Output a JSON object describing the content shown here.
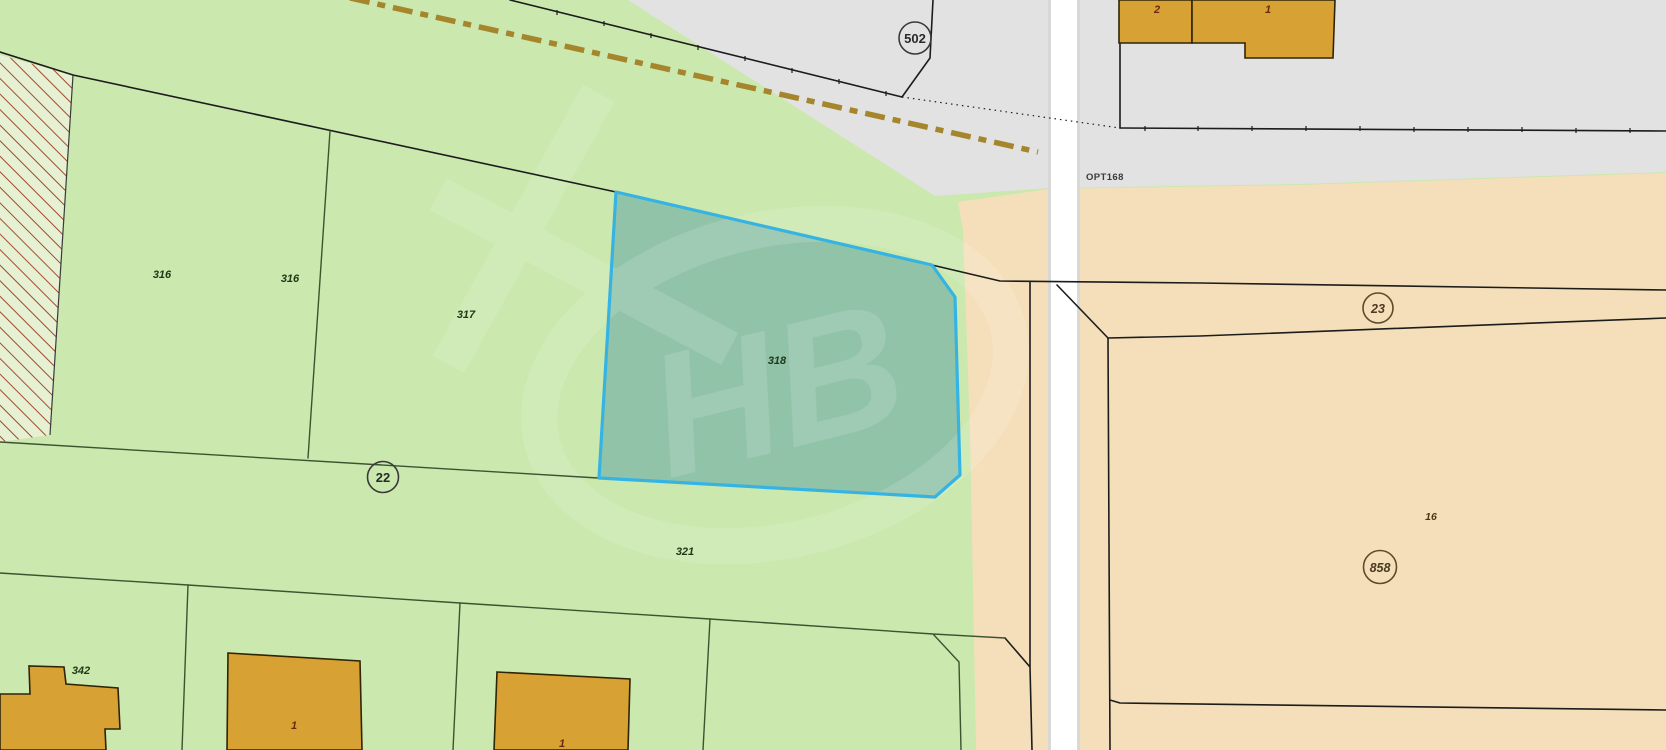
{
  "map": {
    "watermark": "HB",
    "annotation_pt": "OPT168",
    "parcel_labels": {
      "p316_a": "316",
      "p316_b": "316",
      "p317": "317",
      "p318": "318",
      "p321": "321",
      "p342": "342",
      "p16": "16"
    },
    "road_markers": {
      "m502": "502",
      "m22": "22",
      "m23": "23",
      "m858": "858"
    },
    "building_labels": {
      "top_b2": "2",
      "top_b1": "1",
      "left_b1": "1",
      "mid_b1": "1"
    },
    "colors": {
      "green": "#cbe8ae",
      "gray": "#e2e2e2",
      "tan": "#f4dfba",
      "road_fill": "#ffffff",
      "road_edge": "#d8d8d8",
      "parcel_fill": "rgba(88,158,164,0.5)",
      "parcel_stroke": "#35b4e4",
      "building_fill": "#d7a233",
      "building_stroke": "#2f2408",
      "hatch_bg": "#e6f0d3",
      "hatch_line": "#a34a2e",
      "dashed_line": "#a5862c",
      "line_black": "#1c1c1c",
      "line_green": "#3c5330"
    }
  }
}
